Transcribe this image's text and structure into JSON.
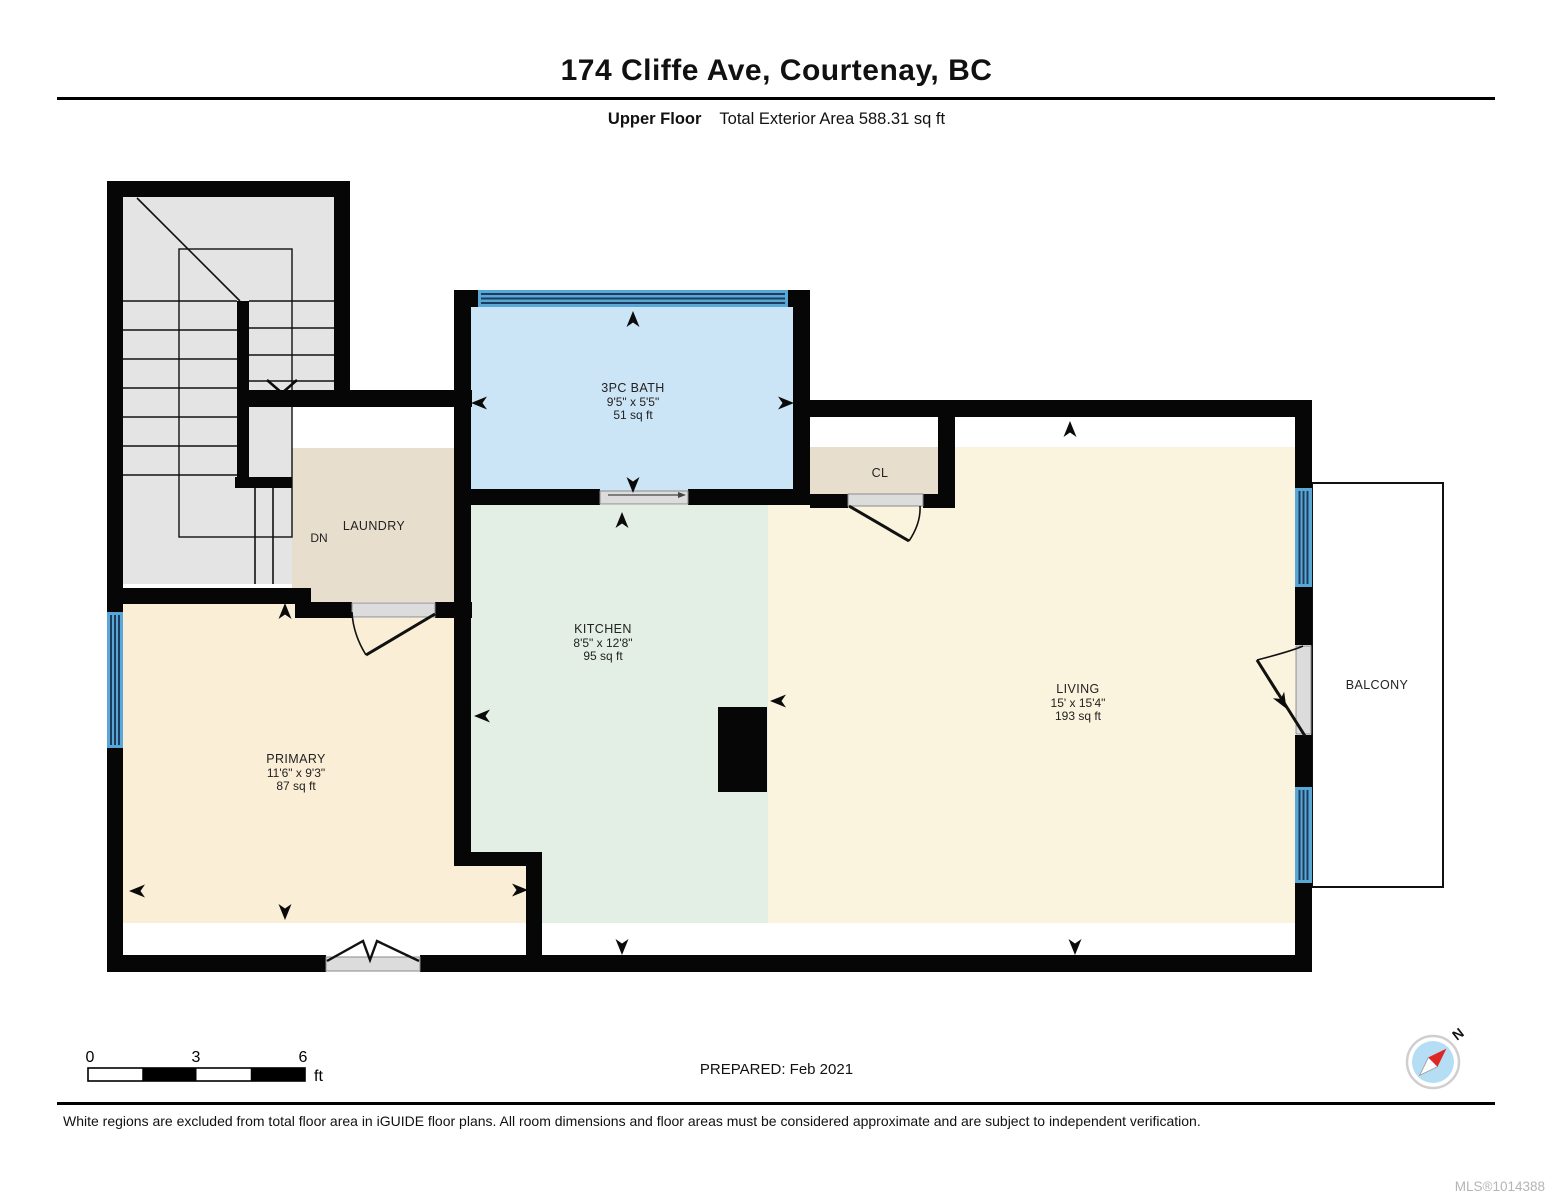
{
  "header": {
    "title": "174 Cliffe Ave, Courtenay, BC",
    "floor_label": "Upper Floor",
    "area_label": "Total Exterior Area 588.31 sq ft"
  },
  "rooms": {
    "bath": {
      "name": "3PC BATH",
      "dims": "9'5\" x 5'5\"",
      "area": "51 sq ft"
    },
    "laundry": {
      "name": "LAUNDRY"
    },
    "stairs": {
      "direction_label": "DN"
    },
    "closet": {
      "name": "CL"
    },
    "kitchen": {
      "name": "KITCHEN",
      "dims": "8'5\" x 12'8\"",
      "area": "95 sq ft"
    },
    "living": {
      "name": "LIVING",
      "dims": "15' x 15'4\"",
      "area": "193 sq ft"
    },
    "primary": {
      "name": "PRIMARY",
      "dims": "11'6\" x 9'3\"",
      "area": "87 sq ft"
    },
    "balcony": {
      "name": "BALCONY"
    }
  },
  "scale_bar": {
    "tick_0": "0",
    "tick_3": "3",
    "tick_6": "6",
    "unit": "ft"
  },
  "prepared_label": "PREPARED: Feb 2021",
  "compass": {
    "north_label": "N"
  },
  "footer": {
    "disclaimer": "White regions are excluded from total floor area in iGUIDE floor plans. All room dimensions and floor areas must be considered approximate and are subject to independent verification.",
    "mls": "MLS®1014388"
  },
  "colors": {
    "wall": "#060606",
    "stairs_fill": "#e4e4e4",
    "bath_fill": "#cbe4f6",
    "window_fill": "#58a7d7",
    "window_line": "#1e3c5c",
    "laundry_fill": "#e8decd",
    "closet_fill": "#e8decd",
    "kitchen_fill": "#e3eee5",
    "living_fill": "#faf3dd",
    "primary_fill": "#faefd6",
    "door_sill": "#dcdcdc",
    "compass_blue": "#b5ddf4",
    "compass_red": "#e02525"
  }
}
